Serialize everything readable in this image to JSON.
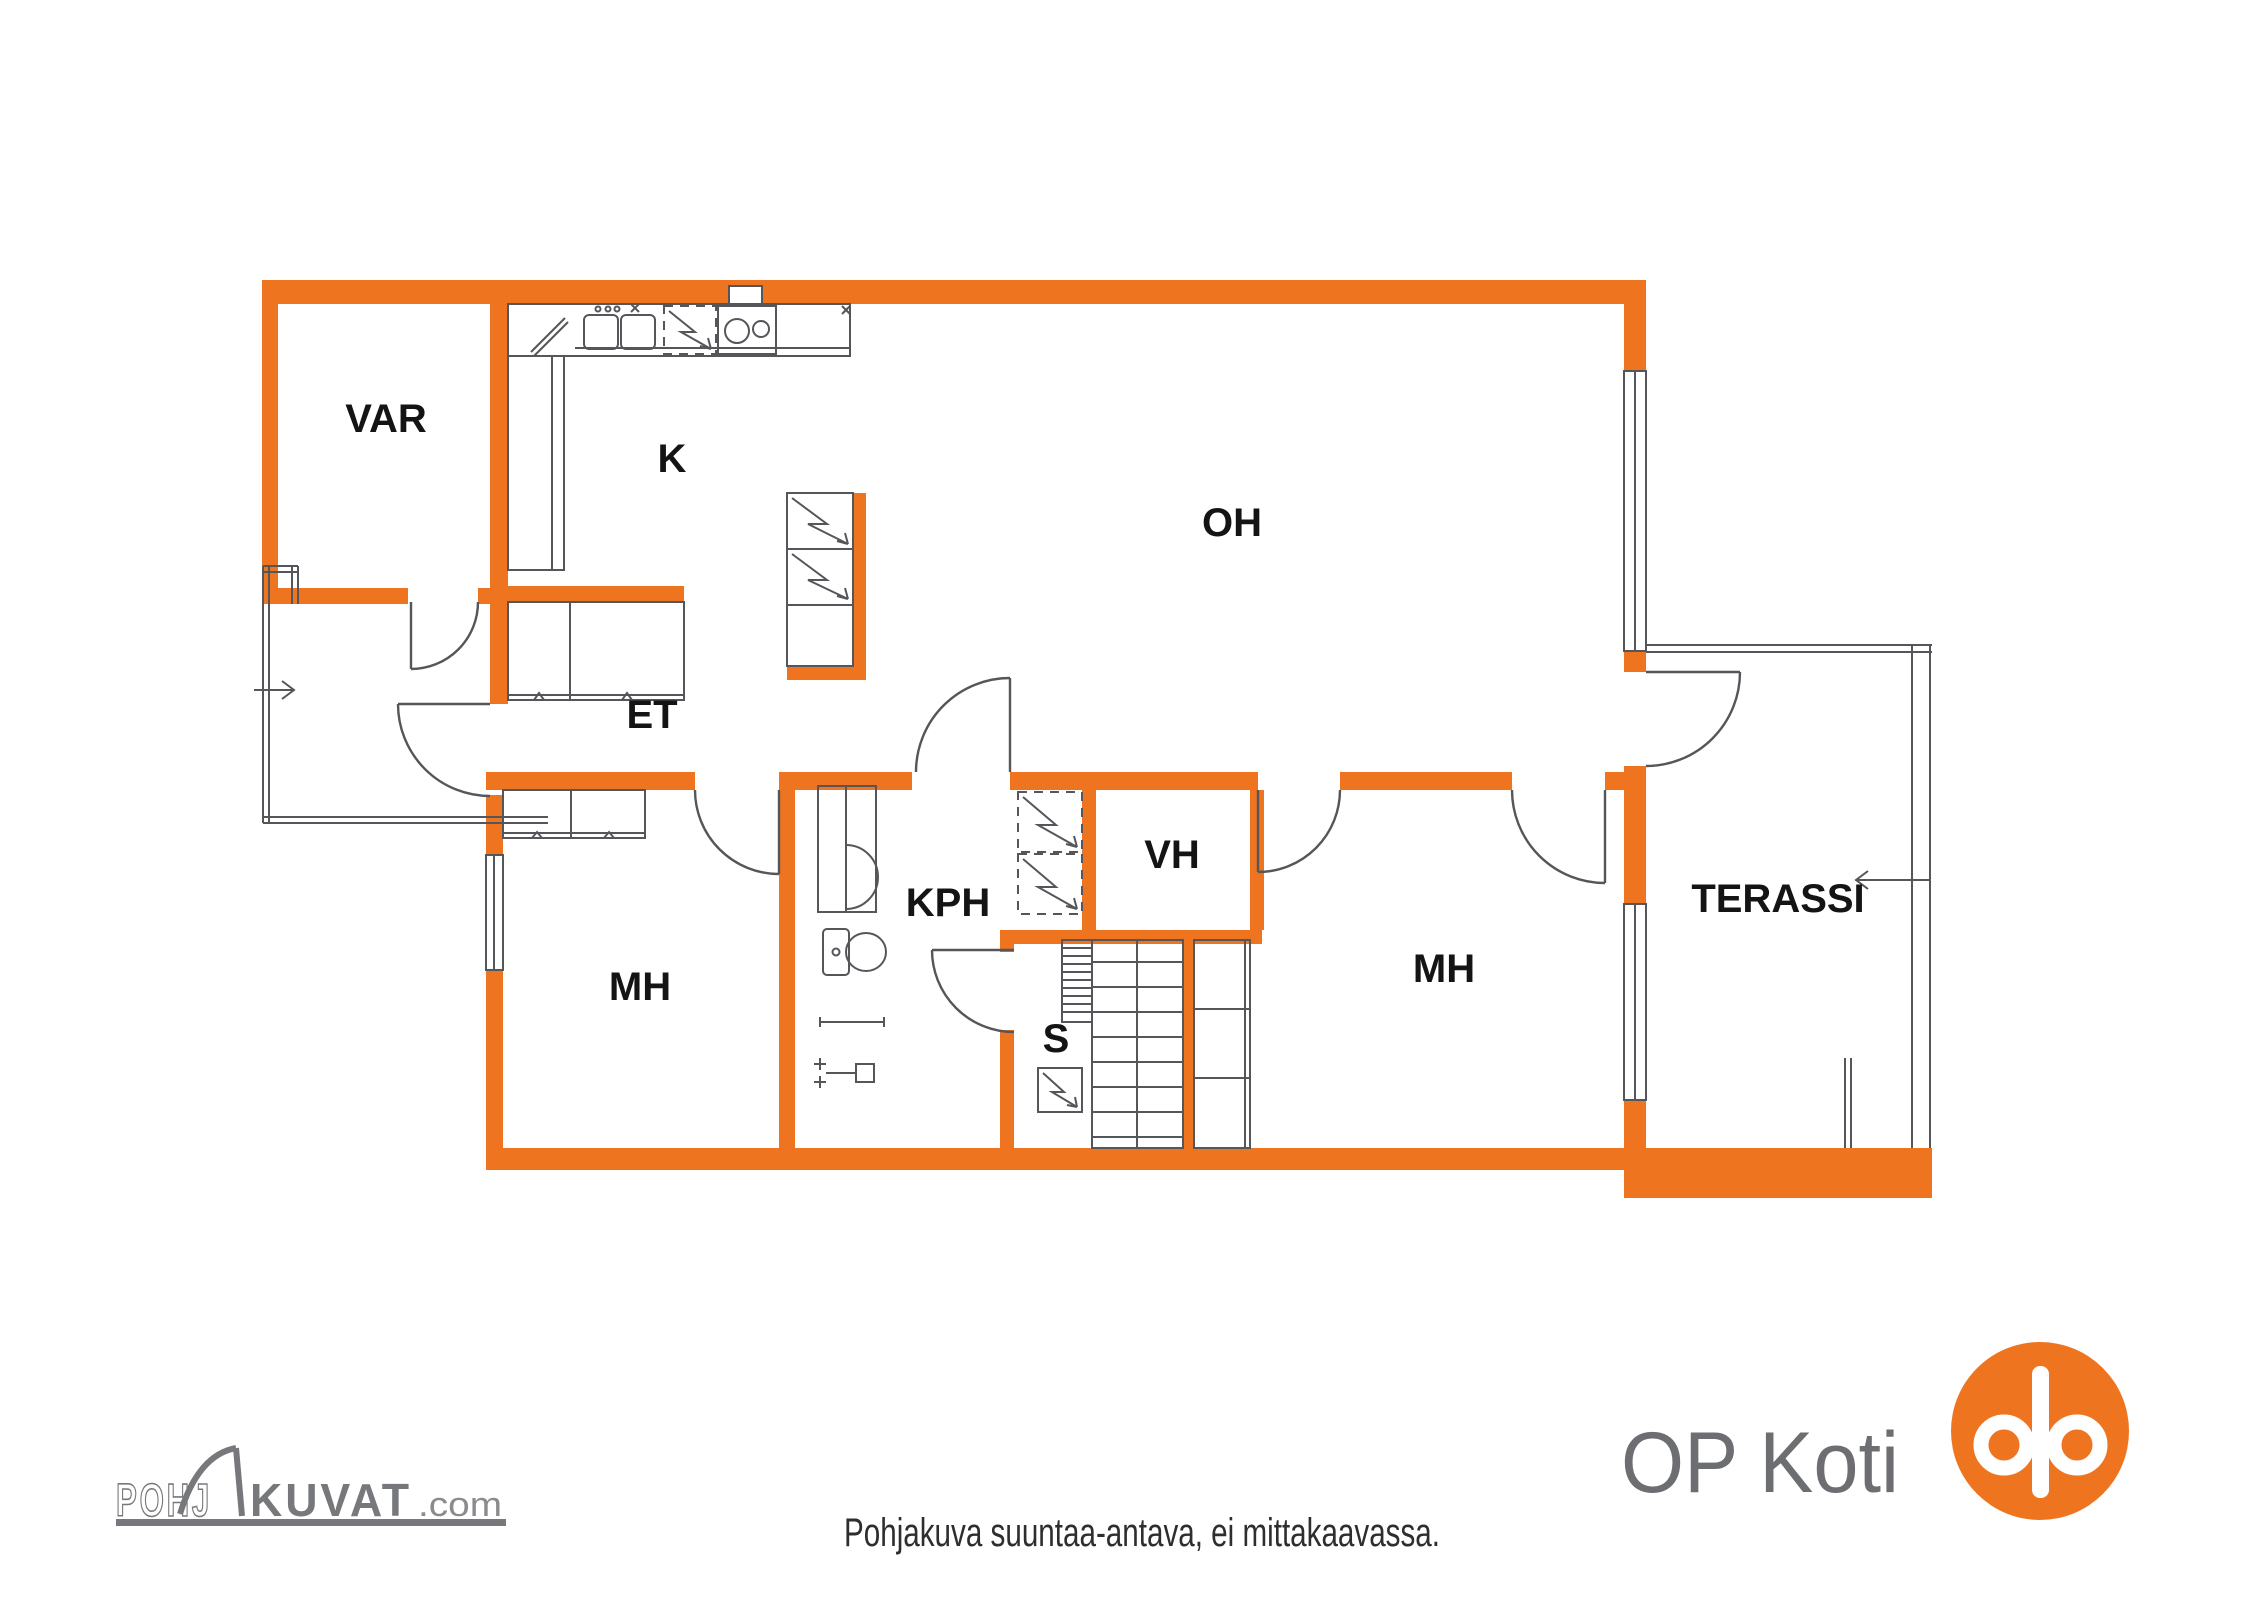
{
  "rooms": [
    {
      "id": "var",
      "label": "VAR"
    },
    {
      "id": "k",
      "label": "K"
    },
    {
      "id": "oh",
      "label": "OH"
    },
    {
      "id": "et",
      "label": "ET"
    },
    {
      "id": "mh_left",
      "label": "MH"
    },
    {
      "id": "kph",
      "label": "KPH"
    },
    {
      "id": "vh",
      "label": "VH"
    },
    {
      "id": "s",
      "label": "S"
    },
    {
      "id": "mh_right",
      "label": "MH"
    },
    {
      "id": "terassi",
      "label": "TERASSI"
    }
  ],
  "footer": {
    "disclaimer": "Pohjakuva suuntaa-antava, ei mittakaavassa."
  },
  "branding": {
    "op_koti": {
      "text": "OP Koti"
    },
    "pohjakuvat": {
      "part1": "POHJ",
      "part2": "KUVAT",
      "suffix": ".com"
    }
  },
  "colors": {
    "wall_orange": "#EE7420",
    "line_gray": "#55565A",
    "label_black": "#141414",
    "caption_gray": "#2E2E2E",
    "op_logo_gray": "#6D6E71",
    "pohjakuvat_gray": "#77787B",
    "op_orange": "#EE7420",
    "background": "#FFFFFF"
  }
}
